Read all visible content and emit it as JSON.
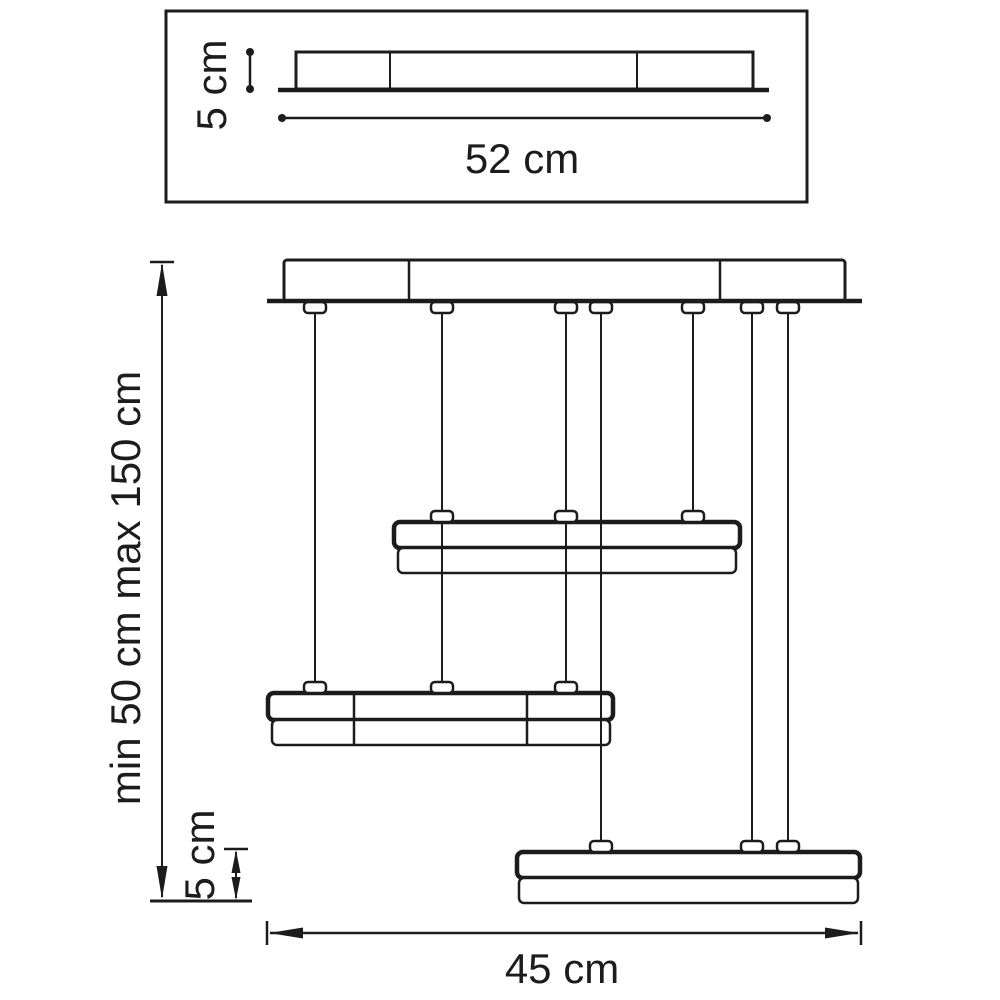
{
  "diagram": {
    "type": "technical-dimension-drawing",
    "subject": "three-tier linear pendant light fixture",
    "colors": {
      "line": "#1c1c1c",
      "background": "#ffffff"
    },
    "top_view": {
      "height_label": "5 cm",
      "width_label": "52 cm"
    },
    "front_view": {
      "suspension_label": "min 50 cm max 150 cm",
      "fixture_height_label": "5 cm",
      "fixture_width_label": "45 cm"
    }
  }
}
